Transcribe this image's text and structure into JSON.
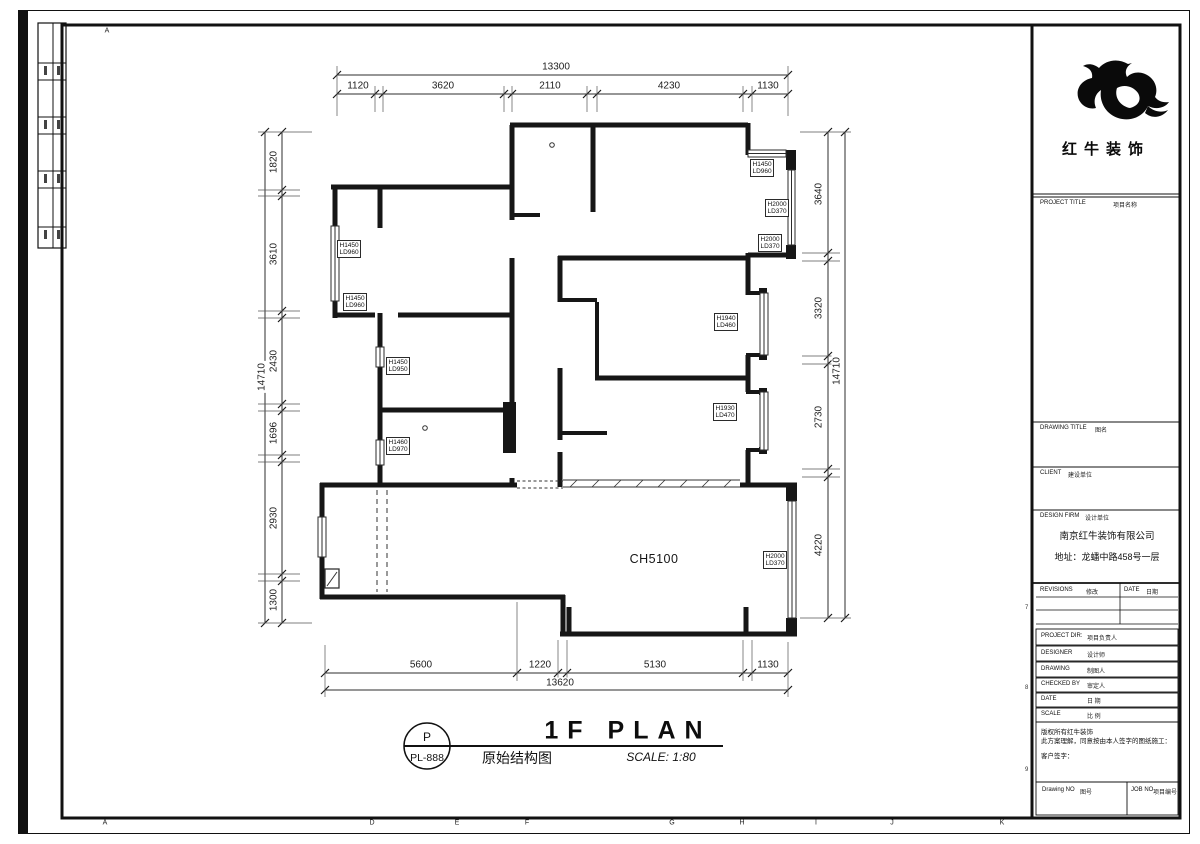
{
  "frame": {
    "top_letters": [
      "A"
    ],
    "bottom_letters": [
      "A",
      "D",
      "E",
      "F",
      "G",
      "H",
      "I",
      "J",
      "K"
    ],
    "right_numbers": [
      "7",
      "8",
      "9"
    ]
  },
  "dimensions": {
    "top": {
      "total": "13300",
      "segments": [
        "1120",
        "3620",
        "2110",
        "4230",
        "1130"
      ]
    },
    "bottom": {
      "total": "13620",
      "segments": [
        "5600",
        "1220",
        "5130",
        "1130"
      ]
    },
    "left": {
      "total": "14710",
      "segments": [
        "1820",
        "3610",
        "2430",
        "1696",
        "2930",
        "1300"
      ]
    },
    "right": {
      "total": "14710",
      "segments": [
        "3640",
        "3320",
        "2730",
        "4220"
      ]
    }
  },
  "plan": {
    "ceiling_label": "CH5100",
    "window_labels": [
      {
        "h": "H1450",
        "ld": "LD960"
      },
      {
        "h": "H1450",
        "ld": "LD960"
      },
      {
        "h": "H1450",
        "ld": "LD950"
      },
      {
        "h": "H1460",
        "ld": "LD970"
      },
      {
        "h": "H1450",
        "ld": "LD960"
      },
      {
        "h": "H2000",
        "ld": "LD370"
      },
      {
        "h": "H2000",
        "ld": "LD370"
      },
      {
        "h": "H1940",
        "ld": "LD460"
      },
      {
        "h": "H1930",
        "ld": "LD470"
      },
      {
        "h": "H2000",
        "ld": "LD370"
      }
    ]
  },
  "title": {
    "letter": "P",
    "code": "PL-888",
    "name_en": "1F PLAN",
    "name_cn": "原始结构图",
    "scale": "SCALE: 1:80"
  },
  "title_block": {
    "logo_text": "红牛装饰",
    "project_title": {
      "en": "PROJECT TITLE",
      "cn": "项目名称"
    },
    "drawing_title": {
      "en": "DRAWING TITLE",
      "cn": "图名"
    },
    "client": {
      "en": "CLIENT",
      "cn": "建设单位"
    },
    "design_firm": {
      "en": "DESIGN FIRM",
      "cn": "设计单位"
    },
    "company": "南京红牛装饰有限公司",
    "address": "地址：龙蟠中路458号一层",
    "revisions": {
      "en": "REVISIONS",
      "cn": "修改"
    },
    "date_col": {
      "en": "DATE",
      "cn": "日期"
    },
    "rows": [
      {
        "en": "PROJECT DIR:",
        "cn": "项目负责人"
      },
      {
        "en": "DESIGNER",
        "cn": "设计师"
      },
      {
        "en": "DRAWING",
        "cn": "制图人"
      },
      {
        "en": "CHECKED BY",
        "cn": "审定人"
      },
      {
        "en": "DATE",
        "cn": "日 期"
      },
      {
        "en": "SCALE",
        "cn": "比 例"
      }
    ],
    "copyright": {
      "line1": "版权所有红牛装饰",
      "line2": "此方案理解，同意按由本人签字的图纸施工：",
      "client_sign": "客户签字："
    },
    "drawing_no": {
      "en": "Drawing NO",
      "cn": "图号"
    },
    "job_no": {
      "en": "JOB NO",
      "cn": "项目编号"
    }
  }
}
